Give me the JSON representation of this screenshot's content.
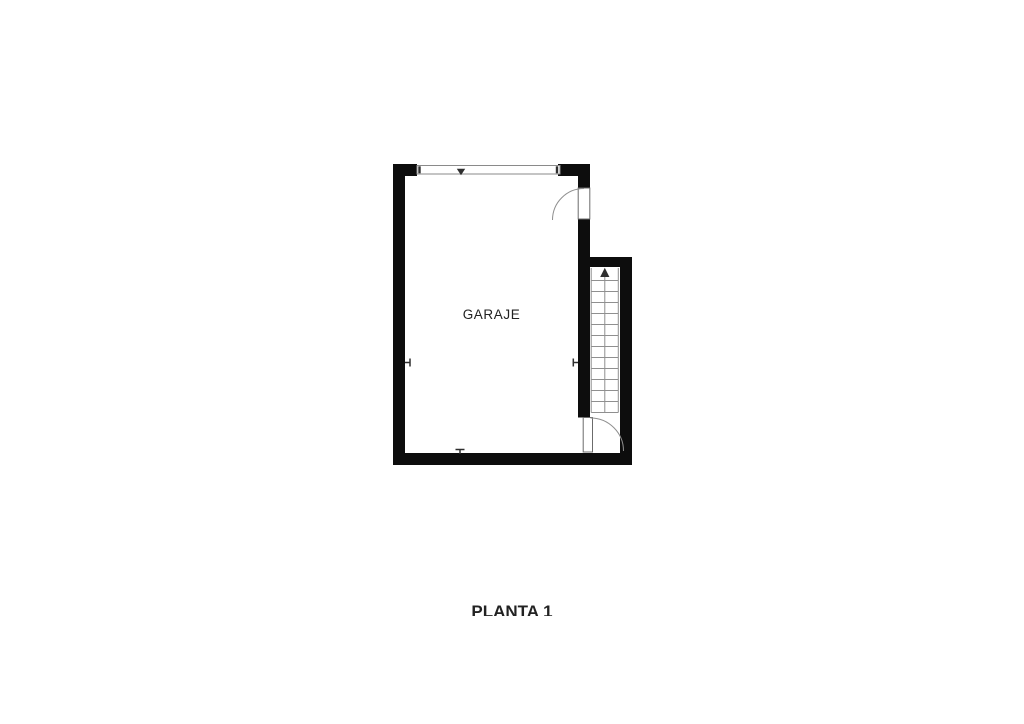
{
  "page": {
    "background": "#ffffff"
  },
  "plan": {
    "room_label": "GARAJE",
    "floor_label": "PLANTA 1",
    "colors": {
      "wall": "#0d0d0d",
      "line": "#8f8f8f",
      "marker": "#2f2f2f",
      "text": "#222222",
      "background": "#ffffff"
    },
    "stairs": {
      "tread_count": 13,
      "direction_arrow": "up"
    },
    "doors": [
      {
        "name": "garage-entry-door",
        "type": "swing"
      },
      {
        "name": "stair-door",
        "type": "swing"
      }
    ],
    "garage_door": {
      "type": "wide-opening-double-line"
    }
  }
}
